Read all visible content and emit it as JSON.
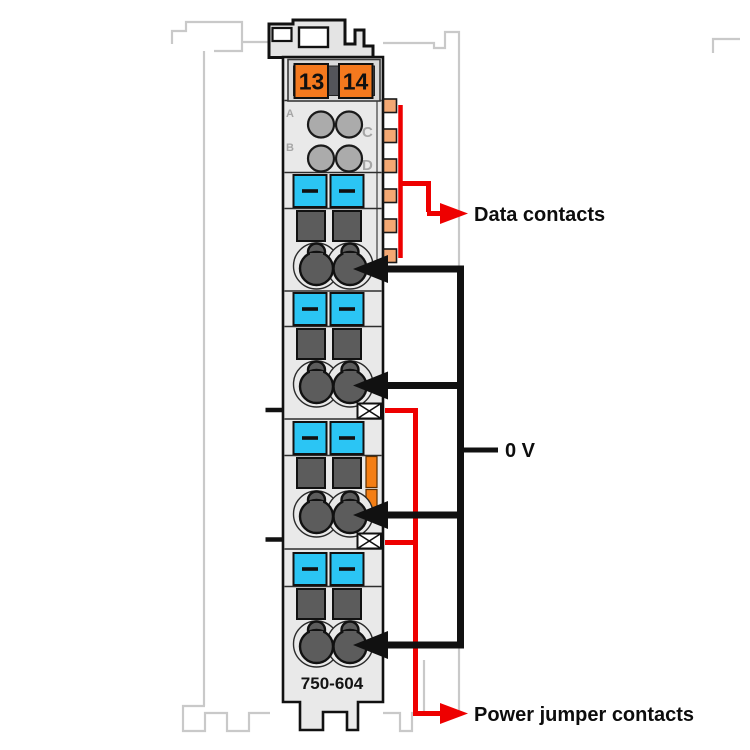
{
  "module": {
    "part_number": "750-604",
    "power_terminals": [
      "13",
      "14"
    ],
    "data_contact_letters": [
      "A",
      "B",
      "C",
      "D"
    ]
  },
  "labels": {
    "data_contacts": "Data contacts",
    "voltage": "0 V",
    "power_jumper_contacts": "Power jumper contacts"
  },
  "colors": {
    "annotation_red": "#ee0000",
    "terminal_orange": "#f4791e",
    "tab_orange": "#f3a873",
    "latch_orange": "#f47e14",
    "clamp_cyan": "#2bc5f4",
    "contact_dark_gray": "#5c5c5c",
    "module_body_gray": "#e9e9e9",
    "outline_black": "#1a1a1a",
    "background_outline_gray": "#c9c9c9"
  }
}
